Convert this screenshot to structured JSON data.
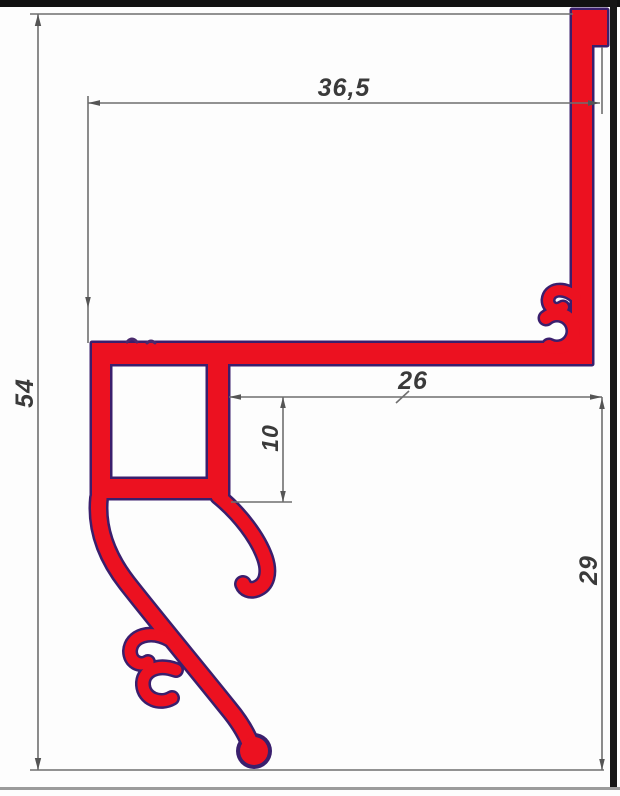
{
  "dimensions": {
    "width_top": "36,5",
    "height_total": "54",
    "width_flange": "26",
    "height_box": "10",
    "height_leg": "29"
  },
  "colors": {
    "profile_fill": "#ec1120",
    "profile_outline": "#3a1f6d",
    "dimension_line": "#6f6f6f",
    "arrow_fill": "#555555",
    "dimension_text": "#3a3a3a",
    "frame_border": "#111111",
    "bottom_edge": "#9b9b9b",
    "background": "#fdfdfd"
  }
}
